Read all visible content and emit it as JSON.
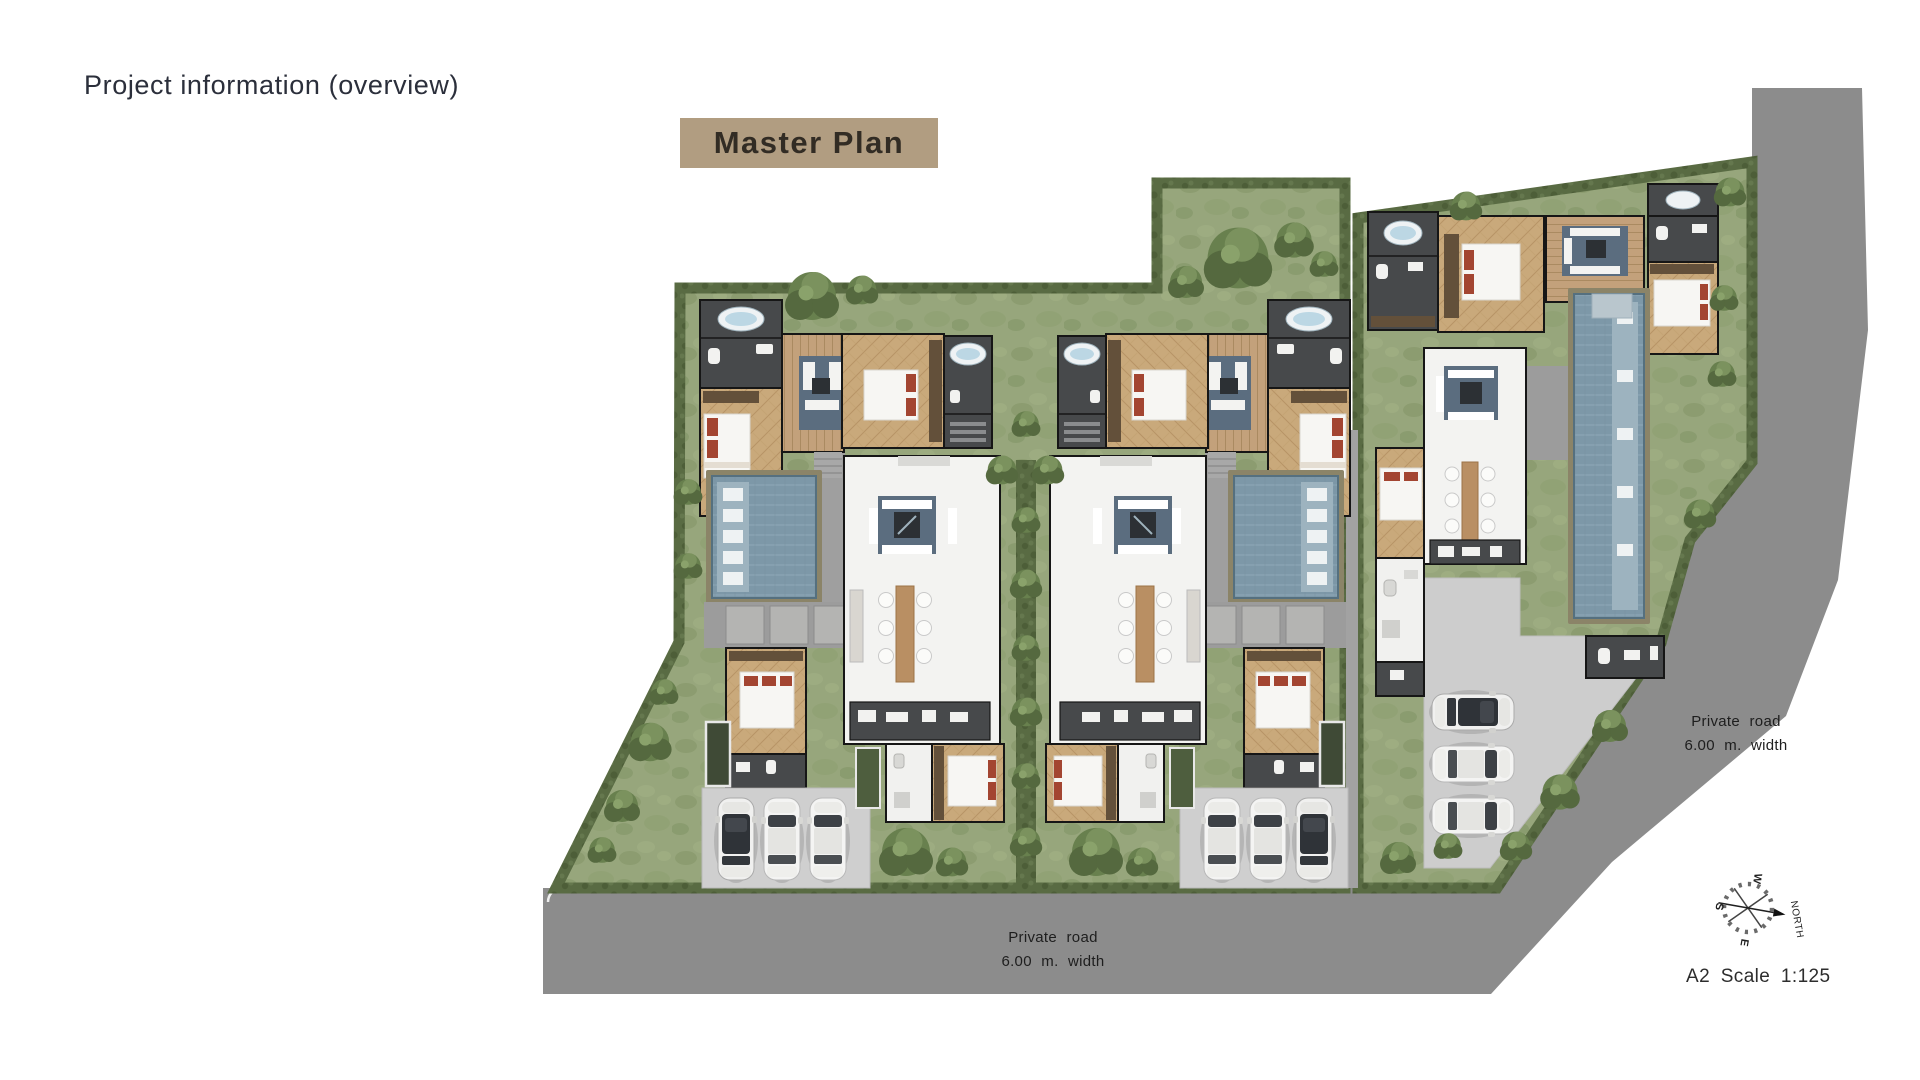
{
  "page": {
    "title": "Project information (overview)"
  },
  "plan": {
    "badge": {
      "label": "Master Plan",
      "bg_color": "#b19d81",
      "text_color": "#322c24"
    },
    "labels": {
      "road_bottom": {
        "line1": "Private road",
        "line2": "6.00 m. width"
      },
      "road_right": {
        "line1": "Private road",
        "line2": "6.00 m. width"
      }
    },
    "compass": {
      "north_label": "NORTH",
      "cardinal_w": "W",
      "cardinal_s": "S",
      "cardinal_e": "E"
    },
    "scale_note": "A2 Scale 1:125",
    "colors": {
      "road": "#8c8c8c",
      "parking_pad": "#cfcfcf",
      "grass": "#97a67c",
      "hedge": "#58693f",
      "pool_water": "#7d98a8",
      "wood_deck": "#c3a17b",
      "bedroom_floor": "#c9a97b",
      "dark_room": "#47494b",
      "white_room": "#f3f3f1",
      "rug": "#5b6d7f",
      "accent_pillow": "#a34531"
    }
  }
}
